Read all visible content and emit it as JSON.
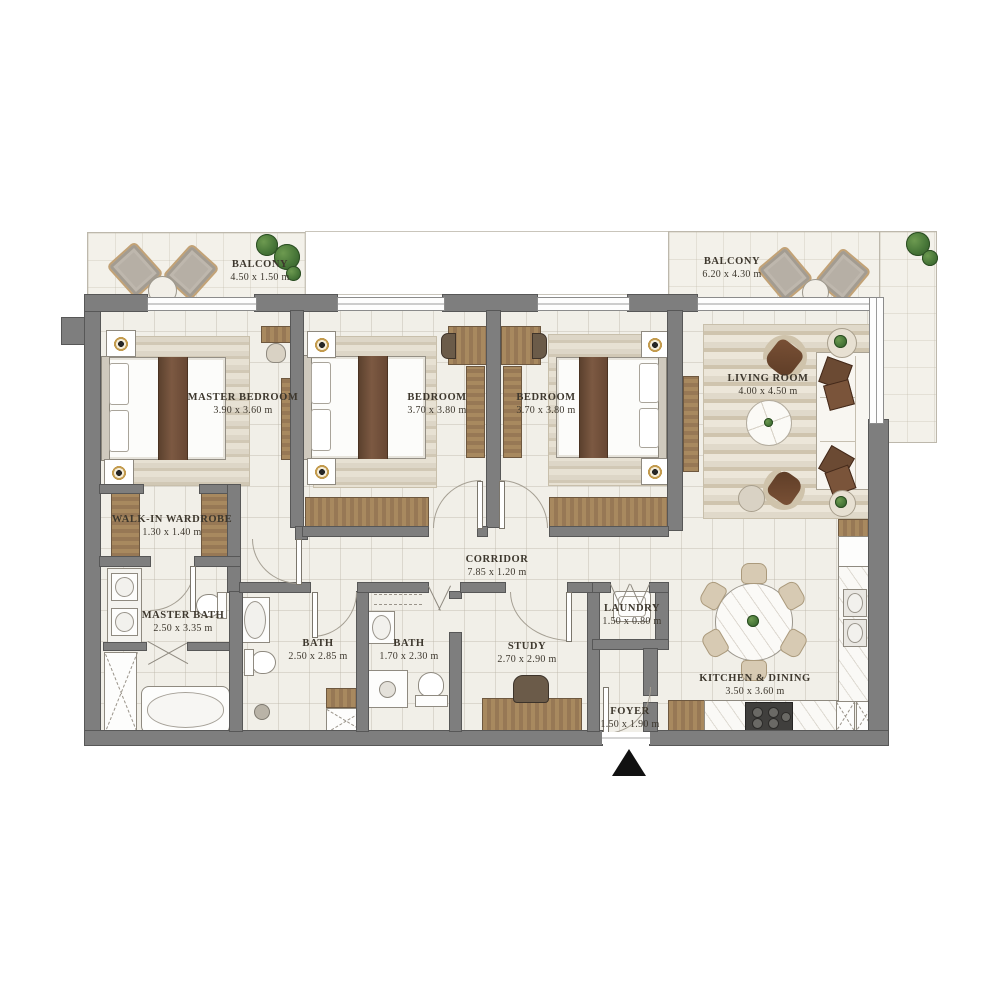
{
  "plan_type": "apartment-floor-plan",
  "rooms": [
    {
      "name": "BALCONY",
      "dims": "4.50 x 1.50 m"
    },
    {
      "name": "BALCONY",
      "dims": "6.20 x 4.30 m"
    },
    {
      "name": "MASTER BEDROOM",
      "dims": "3.90 x 3.60 m"
    },
    {
      "name": "BEDROOM",
      "dims": "3.70 x 3.80 m"
    },
    {
      "name": "BEDROOM",
      "dims": "3.70 x 3.80 m"
    },
    {
      "name": "LIVING ROOM",
      "dims": "4.00 x 4.50 m"
    },
    {
      "name": "WALK-IN WARDROBE",
      "dims": "1.30 x 1.40 m"
    },
    {
      "name": "CORRIDOR",
      "dims": "7.85 x 1.20 m"
    },
    {
      "name": "MASTER BATH",
      "dims": "2.50 x 3.35 m"
    },
    {
      "name": "BATH",
      "dims": "2.50 x 2.85 m"
    },
    {
      "name": "BATH",
      "dims": "1.70 x 2.30 m"
    },
    {
      "name": "STUDY",
      "dims": "2.70 x 2.90 m"
    },
    {
      "name": "LAUNDRY",
      "dims": "1.50 x 0.80 m"
    },
    {
      "name": "KITCHEN & DINING",
      "dims": "3.50 x 3.60 m"
    },
    {
      "name": "FOYER",
      "dims": "1.50 x 1.90 m"
    }
  ],
  "icons": {
    "entrance-arrow": "▲"
  },
  "colors": {
    "wall": "#7e7e7e",
    "wall_edge": "#575757",
    "floor": "#f1efe8",
    "wood": "#9c7e5b",
    "rug": "#d8d0c0",
    "accent_brown": "#6b4a33",
    "plant_green": "#477638",
    "label_text": "#3d372d"
  }
}
